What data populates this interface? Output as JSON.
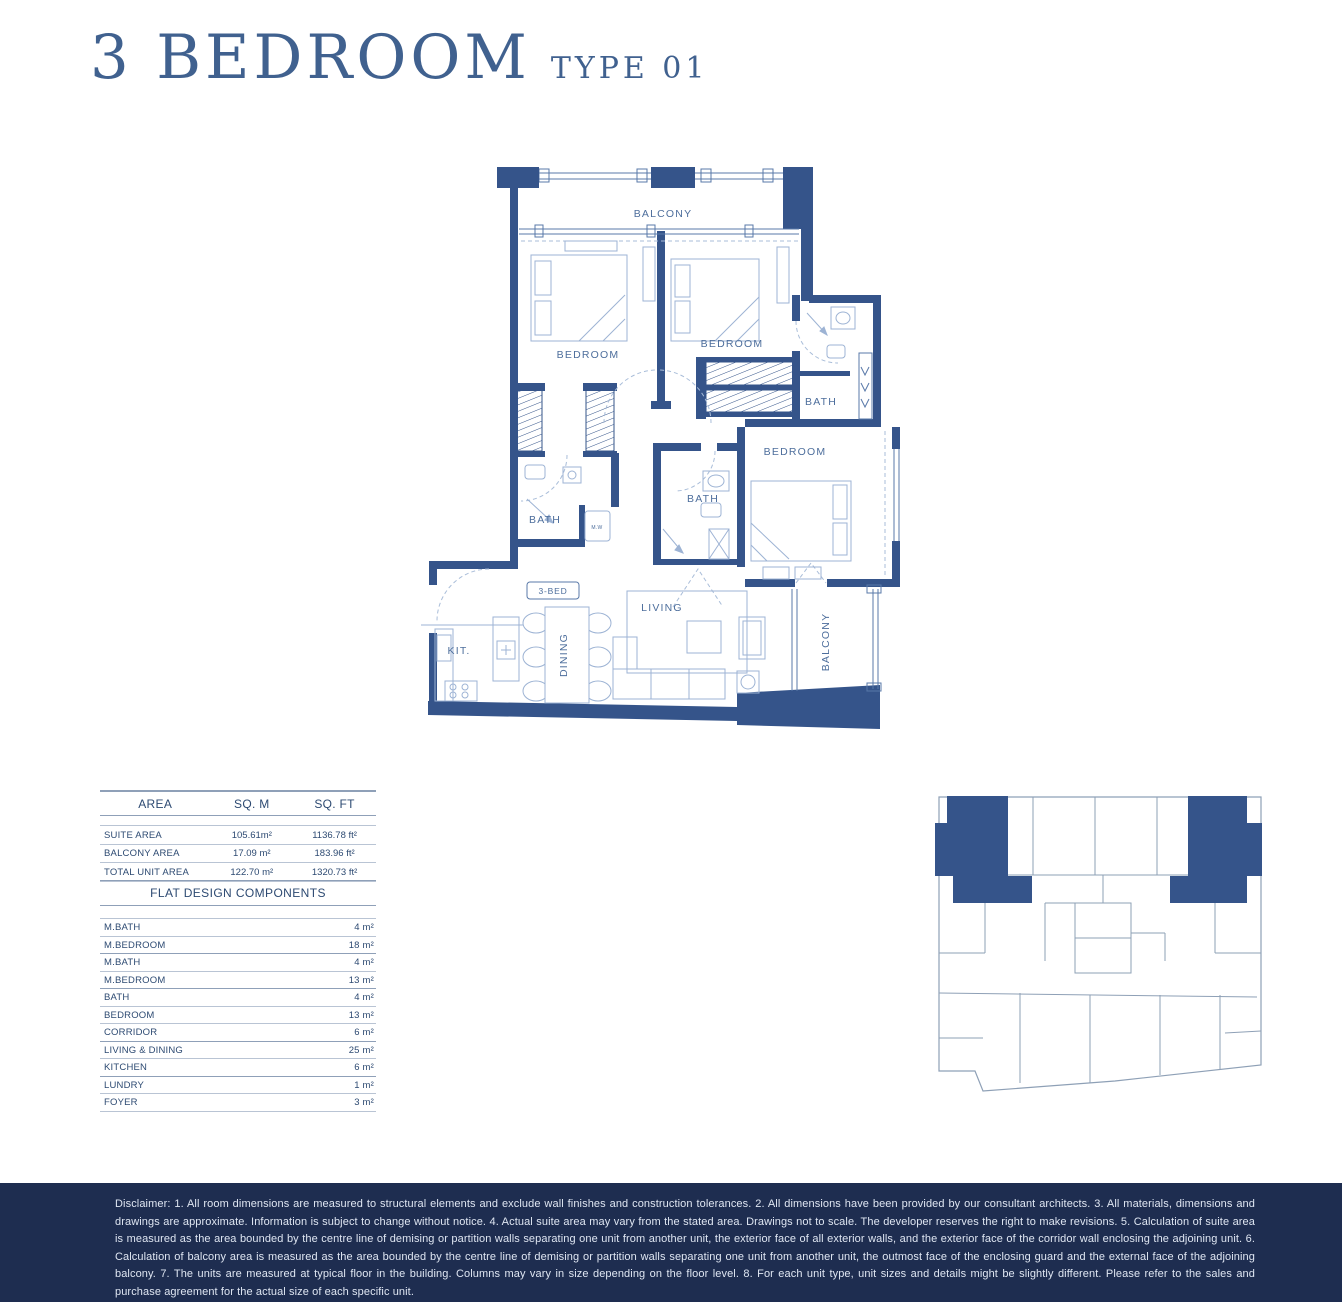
{
  "header": {
    "title": "3 BEDROOM",
    "subtitle": "TYPE 01"
  },
  "floor_plan": {
    "badge": "3-BED",
    "labels": {
      "balcony_top": "BALCONY",
      "bedroom_left": "BEDROOM",
      "bedroom_mid": "BEDROOM",
      "bath_top_right": "BATH",
      "bedroom_right": "BEDROOM",
      "bath_center": "BATH",
      "bath_left": "BATH",
      "washer": "M.W",
      "living": "LIVING",
      "kitchen": "KIT.",
      "dining": "DINING",
      "balcony_right": "BALCONY"
    }
  },
  "area_table": {
    "headers": [
      "AREA",
      "SQ. M",
      "SQ. FT"
    ],
    "rows": [
      {
        "label": "SUITE AREA",
        "sqm": "105.61m²",
        "sqft": "1136.78 ft²"
      },
      {
        "label": "BALCONY AREA",
        "sqm": "17.09 m²",
        "sqft": "183.96 ft²"
      },
      {
        "label": "TOTAL UNIT AREA",
        "sqm": "122.70 m²",
        "sqft": "1320.73 ft²"
      }
    ]
  },
  "components_table": {
    "title": "FLAT DESIGN COMPONENTS",
    "rows": [
      {
        "label": "M.BATH",
        "value": "4 m²"
      },
      {
        "label": "M.BEDROOM",
        "value": "18 m²"
      },
      {
        "label": "M.BATH",
        "value": "4 m²"
      },
      {
        "label": "M.BEDROOM",
        "value": "13 m²"
      },
      {
        "label": "BATH",
        "value": "4 m²"
      },
      {
        "label": "BEDROOM",
        "value": "13 m²"
      },
      {
        "label": "CORRIDOR",
        "value": "6 m²"
      },
      {
        "label": "LIVING & DINING",
        "value": "25 m²"
      },
      {
        "label": "KITCHEN",
        "value": "6 m²"
      },
      {
        "label": "LUNDRY",
        "value": "1 m²"
      },
      {
        "label": "FOYER",
        "value": "3 m²"
      }
    ]
  },
  "disclaimer": "Disclaimer: 1. All room dimensions are measured to structural elements and exclude wall finishes and construction tolerances. 2. All dimensions have been provided by our consultant architects. 3. All materials, dimensions and drawings are approximate. Information is subject to change without notice. 4. Actual suite area may vary from the stated area. Drawings not to scale. The developer reserves the right to make revisions. 5. Calculation of suite area is measured as the area bounded by the centre line of demising or partition walls separating one unit from another unit, the exterior face of all exterior walls, and the exterior face of the corridor wall enclosing the adjoining unit. 6. Calculation of balcony area is measured as the area bounded by the centre line of demising or partition walls separating one unit from another unit, the outmost face of the enclosing guard and the external face of the adjoining balcony. 7. The units are measured at typical floor in the building. Columns may vary in size depending on the floor level. 8. For each unit type, unit sizes and details might be slightly different. Please refer to the sales and purchase agreement for the actual size of each specific unit.",
  "colors": {
    "wall": "#35548a",
    "line": "#5878a8",
    "furn": "#9db3d4",
    "dash": "#a9bdd9",
    "label": "#4d6e9c",
    "tabletext": "#2d4a72",
    "band": "#1e2d50",
    "bandtext": "#dfe6f2",
    "title": "#40618f",
    "key": "#8ea0b6"
  }
}
